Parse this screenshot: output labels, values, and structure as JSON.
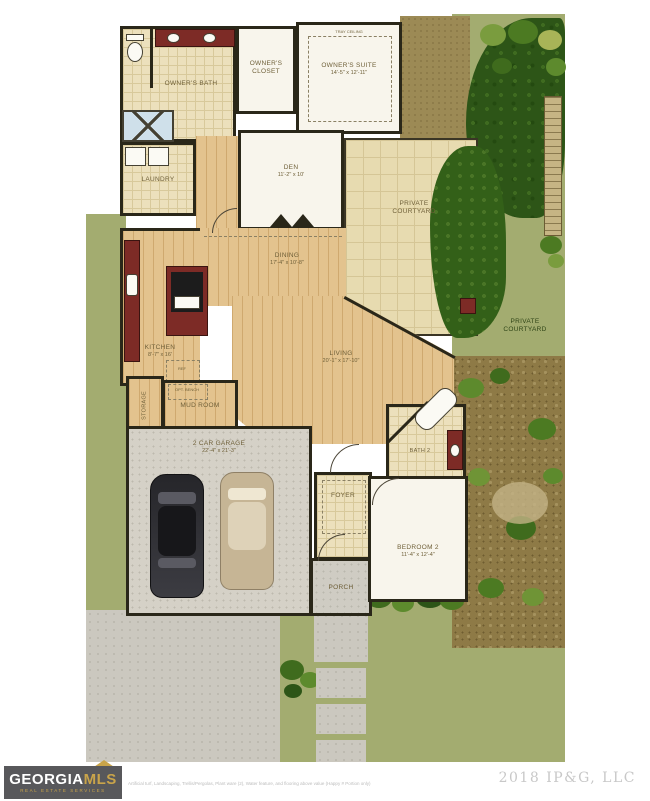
{
  "plan": {
    "rooms": {
      "owners_bath": {
        "label": "OWNER'S BATH"
      },
      "owners_closet": {
        "label": "OWNER'S CLOSET"
      },
      "owners_suite": {
        "label": "OWNER'S SUITE",
        "dims": "14'-5\" x 12'-11\"",
        "ceiling_note": "TRAY CEILING"
      },
      "laundry": {
        "label": "LAUNDRY"
      },
      "den": {
        "label": "DEN",
        "dims": "11'-2\" x 10'"
      },
      "dining": {
        "label": "DINING",
        "dims": "17'-4\" x 10'-8\""
      },
      "kitchen": {
        "label": "KITCHEN",
        "dims": "8'-7\" x 16'"
      },
      "ref": {
        "label": "REF"
      },
      "living": {
        "label": "LIVING",
        "dims": "20'-1\" x 17'-10\""
      },
      "storage": {
        "label": "STORAGE"
      },
      "mud_room": {
        "label": "MUD ROOM"
      },
      "opt_bench": {
        "label": "OPT. BENCH"
      },
      "bath2": {
        "label": "BATH 2"
      },
      "foyer": {
        "label": "FOYER"
      },
      "porch": {
        "label": "PORCH"
      },
      "bedroom2": {
        "label": "BEDROOM 2",
        "dims": "11'-4\" x 12'-4\""
      },
      "garage": {
        "label": "2 CAR GARAGE",
        "dims": "22'-4\" x 21'-3\""
      },
      "courtyard_main": {
        "label": "PRIVATE COURTYARD"
      },
      "courtyard_side": {
        "label": "PRIVATE COURTYARD"
      }
    },
    "colors": {
      "backdrop_olive": "#a3ac70",
      "grass": "#2d5517",
      "wood_floor": "#e3c38e",
      "tile": "#ece0bc",
      "wall": "#2a2719",
      "cabinet_red": "#7d2b26",
      "garage_floor": "#d5d1c7",
      "logo_bg": "#58585b",
      "logo_gold": "#c9a44a"
    }
  },
  "footer": {
    "brand_top": "GEORGIA",
    "brand_accent": "MLS",
    "brand_sub": "REAL ESTATE SERVICES",
    "disclaimer": "Artificial turf, Landscaping, Trellis/Pergolas, Plant ware (2), Water feature, and flooring above value (Happy # Portion only)",
    "copyright": "2018 IP&G, LLC"
  }
}
